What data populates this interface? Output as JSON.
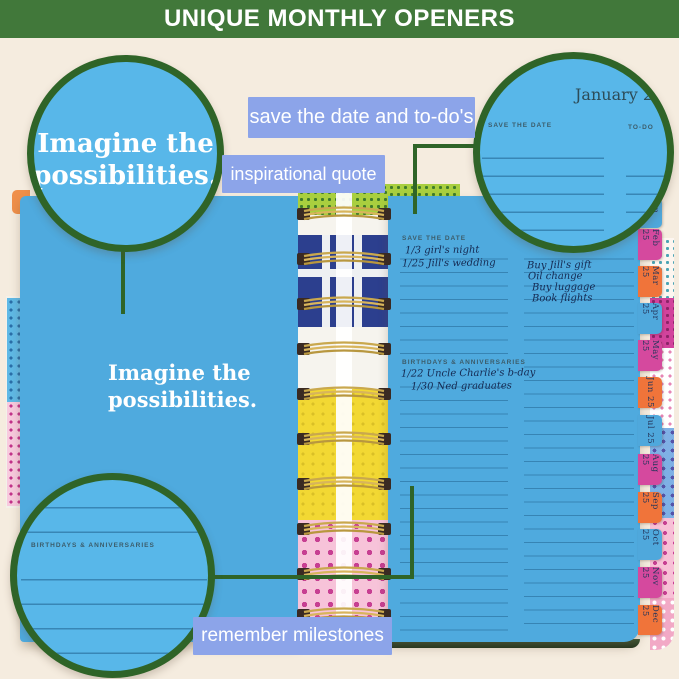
{
  "banner": {
    "title": "UNIQUE MONTHLY OPENERS"
  },
  "callout_labels": {
    "save_the_date": "save the date and to-do's",
    "inspirational": "inspirational quote",
    "milestones": "remember milestones"
  },
  "callout_circles": {
    "quote": {
      "line1": "Imagine the",
      "line2": "possibilities."
    },
    "january": {
      "month": "January 25",
      "save_header": "SAVE THE DATE",
      "todo_header": "TO-DO"
    },
    "milestones": {
      "header": "BIRTHDAYS & ANNIVERSARIES"
    }
  },
  "planner_page": {
    "month": "January 25",
    "quote": {
      "line1": "Imagine the",
      "line2": "possibilities."
    },
    "save_the_date": {
      "header": "SAVE THE DATE",
      "entries": [
        "1/3 girl's night",
        "1/25 Jill's wedding"
      ]
    },
    "todo": {
      "entries": [
        "Buy Jill's gift",
        "Oil change",
        "Buy luggage",
        "Book flights"
      ]
    },
    "birthdays": {
      "header": "BIRTHDAYS & ANNIVERSARIES",
      "entries": [
        "1/22 Uncle Charlie's b-day",
        "1/30 Ned graduates"
      ]
    }
  },
  "month_tabs": [
    {
      "label": "Jan 25",
      "color": "#4fa8dc"
    },
    {
      "label": "Feb 25",
      "color": "#d5499e"
    },
    {
      "label": "Mar 25",
      "color": "#f0743a"
    },
    {
      "label": "Apr 25",
      "color": "#4fa8dc"
    },
    {
      "label": "May 25",
      "color": "#d5499e"
    },
    {
      "label": "Jun 25",
      "color": "#f0743a"
    },
    {
      "label": "Jul 25",
      "color": "#4fa8dc"
    },
    {
      "label": "Aug 25",
      "color": "#d5499e"
    },
    {
      "label": "Sep 25",
      "color": "#f0743a"
    },
    {
      "label": "Oct 25",
      "color": "#4fa8dc"
    },
    {
      "label": "Nov 25",
      "color": "#d5499e"
    },
    {
      "label": "Dec 25",
      "color": "#f0743a"
    }
  ],
  "colors": {
    "background": "#f5ecdf",
    "banner_green": "#41783a",
    "callout_border_green": "#2f6428",
    "page_blue": "#4faade",
    "circle_blue": "#58b7e9",
    "label_periwinkle": "#8ca4e9",
    "tab_pink": "#d5499e",
    "tab_orange": "#f0743a",
    "tab_blue": "#4fa8dc",
    "coil_gold": "#c9a84e"
  }
}
